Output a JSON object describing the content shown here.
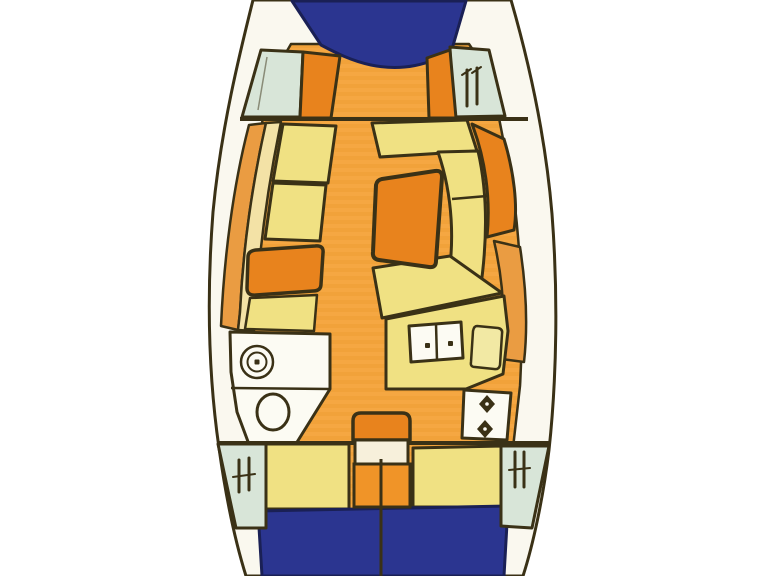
{
  "page": {
    "kind": "boat-deck-plan",
    "subject": "sailing-yacht-interior-layout-top-view"
  },
  "palette": {
    "background": "#FFFFFF",
    "hull_white": "#FAF8EF",
    "outline": "#3A3116",
    "deck_blue": "#2B3590",
    "deck_blue_outline": "#1A2055",
    "floor_orange": "#F5A742",
    "floor_stripe": "#EC9C30",
    "dark_orange": "#E8831D",
    "mid_orange": "#F09428",
    "shelf_orange": "#EA9C42",
    "cushion_yellow": "#F0E183",
    "pale_yellow": "#F2E9A4",
    "shelf_cream": "#F3E2A6",
    "locker_green": "#D8E5D8",
    "fixture_white": "#FCFBF3",
    "landing_cream": "#F7F0DB"
  },
  "regions": {
    "page-background": "background",
    "hull": "hull_white",
    "floor-base": "floor_orange",
    "floor-stripe": "floor_stripe",
    "bow-deck": "deck_blue",
    "stern-deck": "deck_blue",
    "fwd-locker-port": "locker_green",
    "fwd-locker-stbd": "locker_green",
    "vberth-port": "dark_orange",
    "vberth-stbd": "dark_orange",
    "port-shelf-outer": "shelf_orange",
    "port-shelf-inner": "shelf_cream",
    "settee-fwd": "cushion_yellow",
    "settee-aft": "cushion_yellow",
    "chart-table": "dark_orange",
    "settee-strip": "cushion_yellow",
    "dinette-bench-top": "cushion_yellow",
    "dinette-bench-right": "cushion_yellow",
    "dinette-bench-bottom": "cushion_yellow",
    "dinette-backrest": "dark_orange",
    "stbd-shelf": "shelf_orange",
    "salon-table": "dark_orange",
    "head-compartment": "fixture_white",
    "head-sink": "fixture_white",
    "toilet": "fixture_white",
    "galley-counter": "cushion_yellow",
    "galley-sink-unit": "fixture_white",
    "galley-icebox": "pale_yellow",
    "stove": "fixture_white",
    "aft-berth-port": "cushion_yellow",
    "aft-berth-stbd": "cushion_yellow",
    "companionway-steps": "dark_orange",
    "companionway-landing": "landing_cream",
    "engine-hatch": "mid_orange",
    "aft-hatch-port": "locker_green",
    "aft-hatch-stbd": "locker_green",
    "sink-drain": "outline",
    "stove-burner": "outline"
  }
}
